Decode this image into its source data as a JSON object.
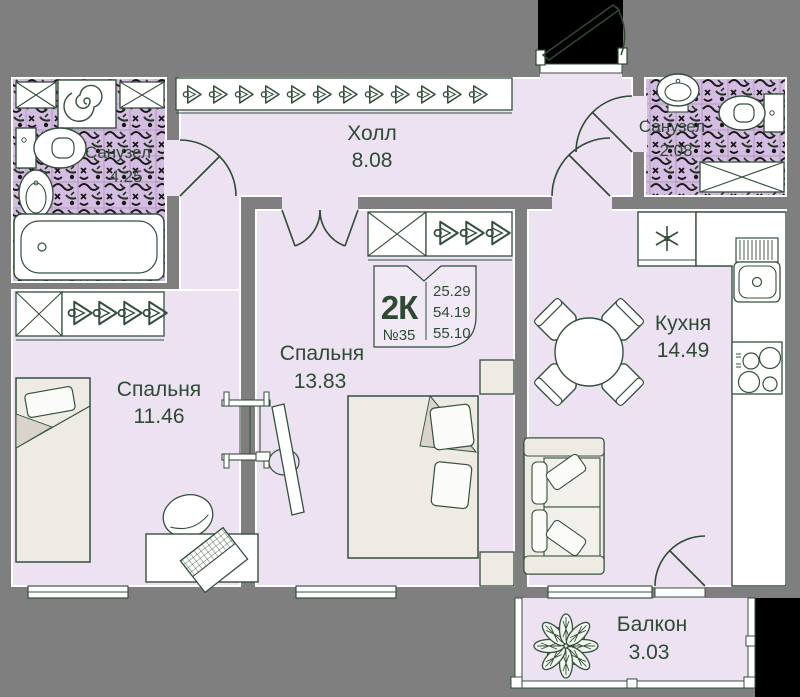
{
  "stamp": {
    "type": "2К",
    "unit": "№35",
    "areas": {
      "living": "25.29",
      "apartment": "54.19",
      "total": "55.10"
    }
  },
  "rooms": {
    "hall": {
      "name": "Холл",
      "area": "8.08"
    },
    "bedroom1": {
      "name": "Спальня",
      "area": "11.46"
    },
    "bedroom2": {
      "name": "Спальня",
      "area": "13.83"
    },
    "kitchen": {
      "name": "Кухня",
      "area": "14.49"
    },
    "bathroom1": {
      "name": "Санузел",
      "area": "4.25"
    },
    "bathroom2": {
      "name": "Санузел",
      "area": "2.08"
    },
    "balcony": {
      "name": "Балкон",
      "area": "3.03"
    }
  },
  "colors": {
    "background": "#7f7f7f",
    "floor": "#ece2f2",
    "tile_base": "#d5bce3",
    "line": "#2e4a33",
    "wall_edge": "#ffffff",
    "void": "#000000"
  },
  "icons": [
    "washing-machine-icon",
    "bathtub-icon",
    "toilet-icon",
    "bidet-icon",
    "sink-icon",
    "wardrobe-shelf-icon",
    "hanger-icon",
    "single-bed-icon",
    "double-bed-icon",
    "nightstand-icon",
    "tv-icon",
    "ladder-shelf-icon",
    "desk-icon",
    "office-chair-icon",
    "laptop-icon",
    "fridge-icon",
    "kitchen-counter-icon",
    "kitchen-sink-icon",
    "stove-icon",
    "dining-table-icon",
    "dining-chair-icon",
    "sofa-icon",
    "plant-icon",
    "door-swing-icon",
    "window-icon",
    "entrance-door-icon"
  ]
}
